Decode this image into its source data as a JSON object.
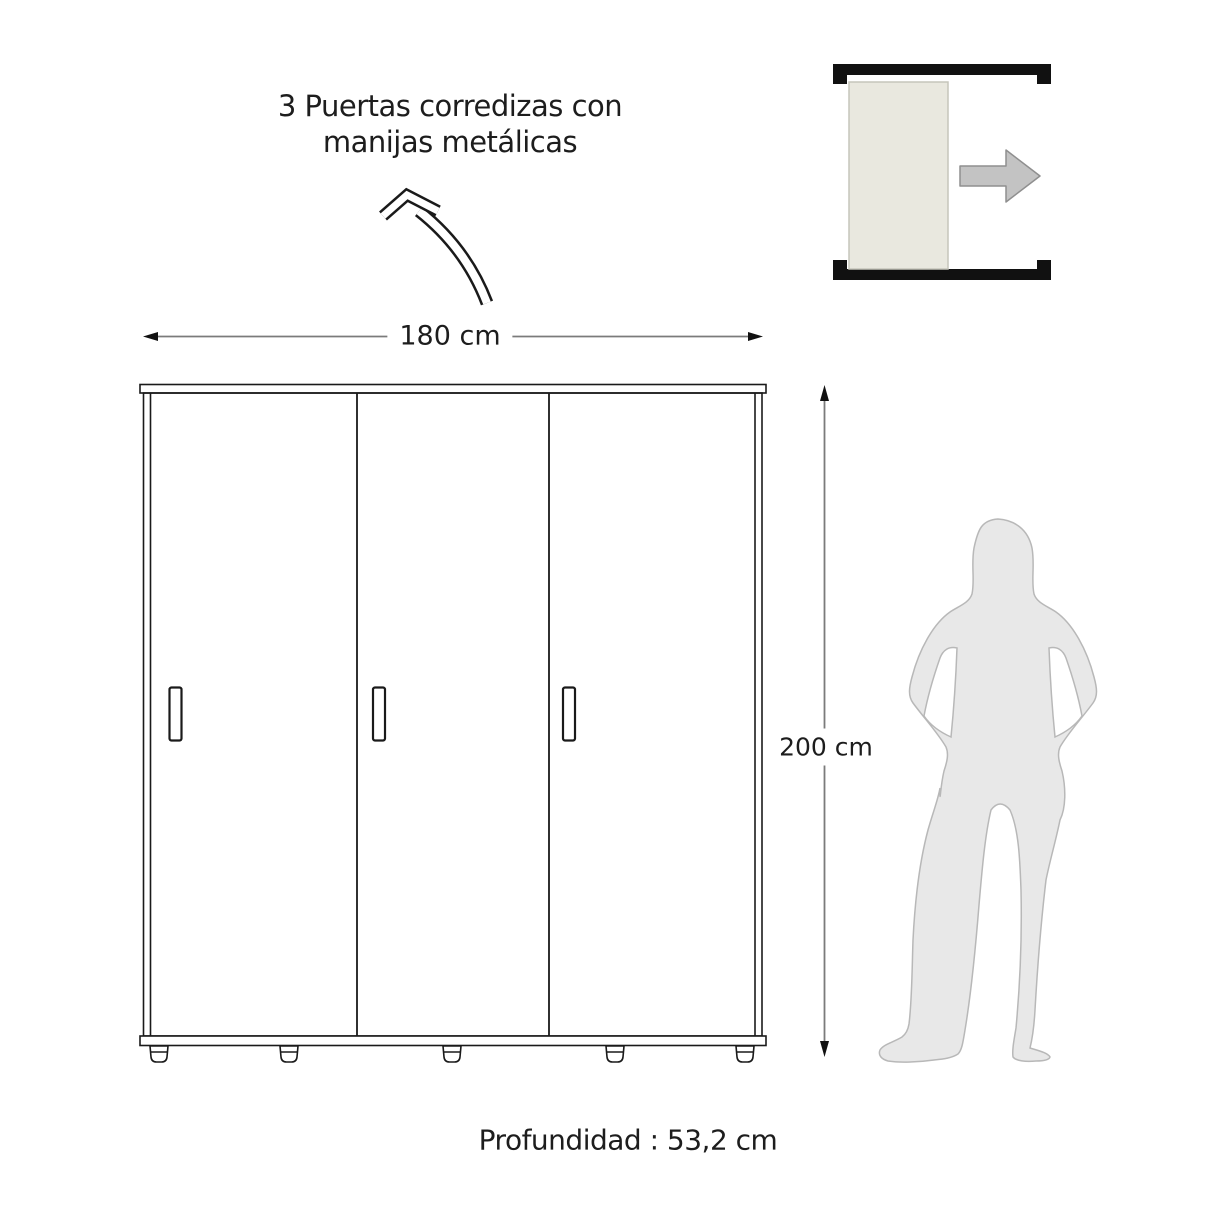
{
  "labels": {
    "title_line1": "3 Puertas corredizas con",
    "title_line2": "manijas metálicas",
    "width_dimension": "180 cm",
    "height_dimension": "200 cm",
    "depth_dimension": "Profundidad : 53,2 cm"
  },
  "wardrobe": {
    "door_count": 3,
    "width_cm": 180,
    "height_cm": 200,
    "depth_cm": "53,2"
  },
  "colors": {
    "line": "#1a1a1a",
    "dimension_line": "#7b7b7b",
    "arrowhead": "#111111",
    "slide_door_fill": "#e9e8df",
    "slide_door_stroke": "#c6c5bb",
    "slide_arrow_fill": "#c3c3c3",
    "slide_arrow_stroke": "#8f8f8f",
    "silhouette_fill": "#e8e8e8",
    "silhouette_stroke": "#b8b8b8",
    "text": "#1d1d1d",
    "background": "#ffffff"
  }
}
